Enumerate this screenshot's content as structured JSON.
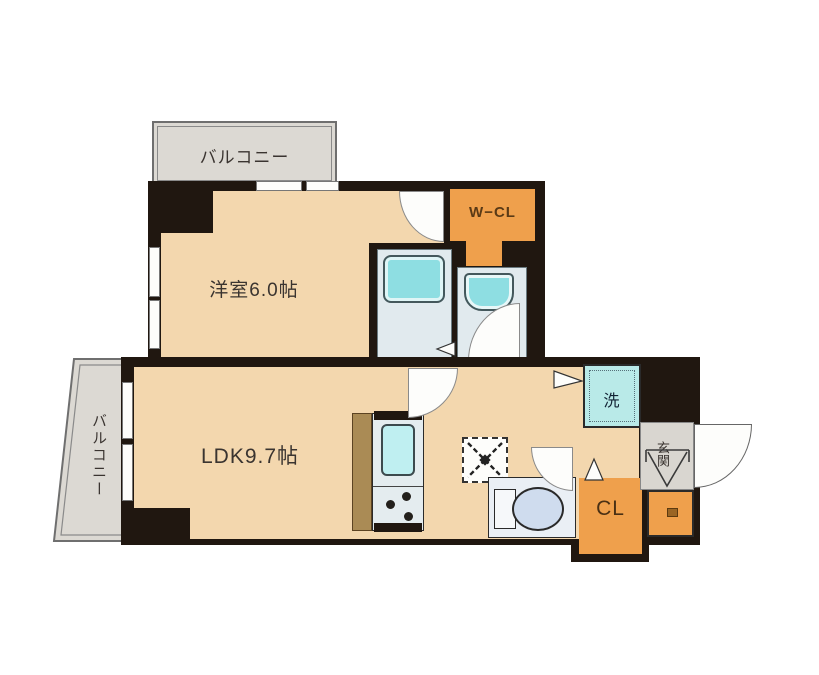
{
  "plan": {
    "type": "apartment-floor-plan",
    "rooms": {
      "balcony_top": {
        "label": "バルコニー"
      },
      "balcony_left": {
        "label": "バルコニー"
      },
      "western_room": {
        "label": "洋室6.0帖"
      },
      "ldk": {
        "label": "LDK9.7帖"
      },
      "walk_in_closet": {
        "label": "W−CL"
      },
      "closet": {
        "label": "CL"
      },
      "washer_space": {
        "label": "洗"
      },
      "entrance": {
        "label": "玄関"
      }
    },
    "fixtures": [
      "bathtub",
      "washbasin",
      "kitchen-sink",
      "stove-burners",
      "refrigerator-space",
      "toilet",
      "shoe-cabinet",
      "washing-machine-space"
    ],
    "colors": {
      "wall": "#201710",
      "floor": "#f3d7ae",
      "storage_orange": "#efa04c",
      "balcony_gray": "#dcd9d3",
      "bath_floor": "#e1eaee",
      "fixture_teal": "#8edee2",
      "washer_teal": "#b9eae8",
      "toilet_bowl": "#cfdcee",
      "kitchen_counter": "#aa8b55"
    }
  }
}
